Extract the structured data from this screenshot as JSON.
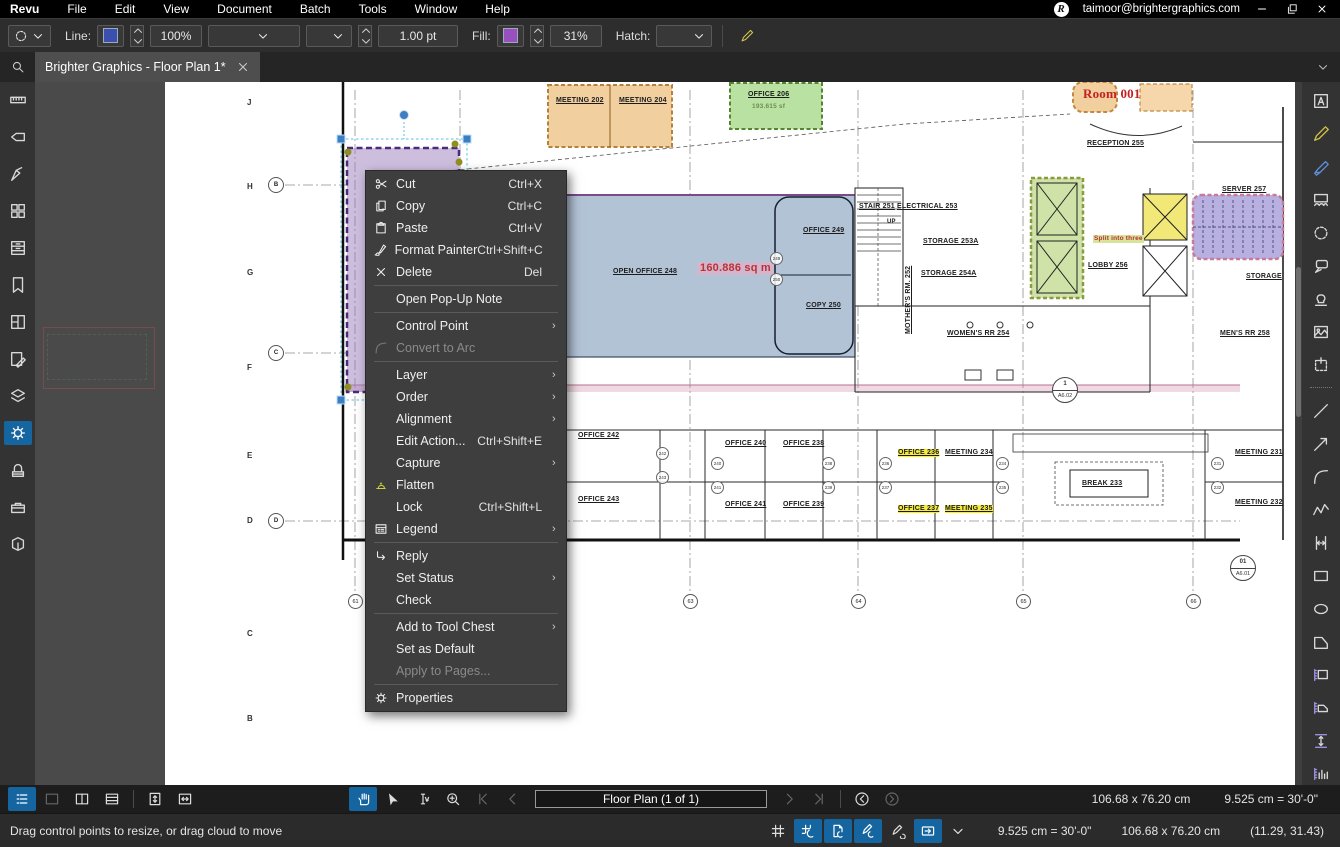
{
  "titlebar": {
    "menus": [
      "Revu",
      "File",
      "Edit",
      "View",
      "Document",
      "Batch",
      "Tools",
      "Window",
      "Help"
    ],
    "account": "taimoor@brightergraphics.com"
  },
  "toolbar": {
    "line_label": "Line:",
    "line_color": "#3b4fae",
    "line_opacity": "100%",
    "stroke_width": "1.00 pt",
    "fill_label": "Fill:",
    "fill_color": "#9a4fc0",
    "fill_opacity": "31%",
    "hatch_label": "Hatch:"
  },
  "tab": {
    "title": "Brighter Graphics - Floor Plan 1*"
  },
  "sidebar_left": {
    "items": [
      {
        "icon": "ruler",
        "name": "measurements-panel"
      },
      {
        "icon": "tag",
        "name": "flags-panel"
      },
      {
        "icon": "calibrate",
        "name": "calibration-panel"
      },
      {
        "icon": "thumbnails",
        "name": "thumbnails-panel"
      },
      {
        "icon": "drawer",
        "name": "file-access-panel"
      },
      {
        "icon": "bookmark",
        "name": "bookmarks-panel"
      },
      {
        "icon": "spaces",
        "name": "spaces-panel"
      },
      {
        "icon": "markups",
        "name": "markups-list-panel"
      },
      {
        "icon": "layers",
        "name": "layers-panel"
      },
      {
        "icon": "gear",
        "name": "tool-chest-panel",
        "active": true
      },
      {
        "icon": "scanner",
        "name": "studio-panel"
      },
      {
        "icon": "toolbox",
        "name": "toolbox-panel"
      },
      {
        "icon": "model",
        "name": "3d-model-panel"
      }
    ]
  },
  "sidebar_right": {
    "items": [
      {
        "icon": "text",
        "name": "text-tool"
      },
      {
        "icon": "pen",
        "name": "pen-tool",
        "color": "#cdbf45"
      },
      {
        "icon": "highlighter",
        "name": "highlighter-tool",
        "color": "#5d8fd6"
      },
      {
        "icon": "cloudrect",
        "name": "cloud-rect-tool"
      },
      {
        "icon": "cloud",
        "name": "cloud-tool"
      },
      {
        "icon": "callout",
        "name": "callout-tool"
      },
      {
        "icon": "stamp",
        "name": "stamp-tool"
      },
      {
        "icon": "image",
        "name": "image-tool"
      },
      {
        "icon": "snapshot",
        "name": "snapshot-tool"
      },
      {
        "divider": true
      },
      {
        "icon": "line",
        "name": "line-tool"
      },
      {
        "icon": "arrow",
        "name": "arrow-tool"
      },
      {
        "icon": "arc",
        "name": "arc-tool"
      },
      {
        "icon": "polyline",
        "name": "polyline-tool"
      },
      {
        "icon": "dimension",
        "name": "dimension-tool"
      },
      {
        "icon": "rect",
        "name": "rectangle-tool"
      },
      {
        "icon": "ellipse",
        "name": "ellipse-tool"
      },
      {
        "icon": "polygon",
        "name": "polygon-tool"
      },
      {
        "icon": "mrect",
        "name": "measure-rectangle-tool"
      },
      {
        "icon": "marea",
        "name": "measure-area-tool"
      },
      {
        "icon": "mlength",
        "name": "measure-length-tool"
      },
      {
        "icon": "mcount",
        "name": "measure-count-tool"
      }
    ]
  },
  "context_menu": {
    "items": [
      {
        "label": "Cut",
        "shortcut": "Ctrl+X",
        "icon": "scissors"
      },
      {
        "label": "Copy",
        "shortcut": "Ctrl+C",
        "icon": "copy"
      },
      {
        "label": "Paste",
        "shortcut": "Ctrl+V",
        "icon": "paste"
      },
      {
        "label": "Format Painter",
        "shortcut": "Ctrl+Shift+C",
        "icon": "brush"
      },
      {
        "label": "Delete",
        "shortcut": "Del",
        "icon": "xmark",
        "sep": true
      },
      {
        "label": "Open Pop-Up Note",
        "sep": true
      },
      {
        "label": "Control Point",
        "submenu": true
      },
      {
        "label": "Convert to Arc",
        "icon": "arc",
        "disabled": true,
        "sep": true
      },
      {
        "label": "Layer",
        "submenu": true
      },
      {
        "label": "Order",
        "submenu": true
      },
      {
        "label": "Alignment",
        "submenu": true
      },
      {
        "label": "Edit Action...",
        "shortcut": "Ctrl+Shift+E"
      },
      {
        "label": "Capture",
        "submenu": true
      },
      {
        "label": "Flatten",
        "icon": "flatten",
        "color": "#cfd13e"
      },
      {
        "label": "Lock",
        "shortcut": "Ctrl+Shift+L"
      },
      {
        "label": "Legend",
        "icon": "legend",
        "submenu": true,
        "sep": true
      },
      {
        "label": "Reply",
        "icon": "reply"
      },
      {
        "label": "Set Status",
        "submenu": true
      },
      {
        "label": "Check",
        "sep": true
      },
      {
        "label": "Add to Tool Chest",
        "submenu": true
      },
      {
        "label": "Set as Default"
      },
      {
        "label": "Apply to Pages...",
        "disabled": true,
        "sep": true
      },
      {
        "label": "Properties",
        "icon": "gear"
      }
    ]
  },
  "plan": {
    "rooms": [
      "MEETING  202",
      "MEETING  204",
      "OFFICE  206",
      "193.615 sf",
      "Room 001",
      "RECEPTION  255",
      "STAIR  251",
      "ELECTRICAL  253",
      "STORAGE  253A",
      "STORAGE  254A",
      "MOTHER'S RM.  252",
      "WOMEN'S RR  254",
      "MEN'S RR  258",
      "OPEN OFFICE  248",
      "160.886 sq m",
      "OFFICE  249",
      "COPY  250",
      "SERVER  257",
      "LOBBY  256",
      "Split into three",
      "STORAGE",
      "OFFICE  242",
      "OFFICE  243",
      "OFFICE  240",
      "OFFICE  241",
      "OFFICE  238",
      "OFFICE  239",
      "OFFICE  236",
      "OFFICE  237",
      "MEETING  234",
      "MEETING  235",
      "BREAK  233",
      "MEETING  231",
      "MEETING  232",
      "UP"
    ],
    "grid_rows": [
      "J",
      "H",
      "G",
      "F",
      "E",
      "D",
      "C",
      "B"
    ],
    "grid_bubbles": [
      "B",
      "C",
      "D"
    ],
    "grid_cols": [
      "61",
      "63",
      "64",
      "65",
      "66"
    ],
    "door_tags": [
      "249",
      "250",
      "242",
      "243",
      "240",
      "241",
      "238",
      "239",
      "236",
      "237",
      "234",
      "235",
      "231",
      "232"
    ],
    "callouts": [
      {
        "num": "1",
        "sheet": "A6.02"
      },
      {
        "num": "01",
        "sheet": "A6.01"
      }
    ]
  },
  "bottom_nav": {
    "left_tools": [
      {
        "icon": "markuplist",
        "name": "markups-list-toggle",
        "active": true
      },
      {
        "icon": "pane1",
        "name": "single-pane",
        "disabled": true
      },
      {
        "icon": "pane2",
        "name": "split-vertical"
      },
      {
        "icon": "pane3",
        "name": "split-horizontal"
      },
      {
        "divider": true
      },
      {
        "icon": "fitpage",
        "name": "fit-page"
      },
      {
        "icon": "fitwidth",
        "name": "fit-width"
      }
    ],
    "center_tools": [
      {
        "icon": "hand",
        "name": "pan-tool",
        "active": true
      },
      {
        "icon": "cursor",
        "name": "select-tool"
      },
      {
        "icon": "textselect",
        "name": "select-text-tool"
      },
      {
        "icon": "zoomplus",
        "name": "zoom-tool"
      },
      {
        "icon": "first",
        "name": "first-page-button",
        "disabled": true
      },
      {
        "icon": "prev",
        "name": "previous-page-button",
        "disabled": true
      },
      {
        "type": "pagebox",
        "name": "page-navigator",
        "bind": "bottom_nav.page_label"
      },
      {
        "icon": "next",
        "name": "next-page-button",
        "disabled": true
      },
      {
        "icon": "last",
        "name": "last-page-button",
        "disabled": true
      },
      {
        "divider": true
      },
      {
        "icon": "prevview",
        "name": "previous-view-button"
      },
      {
        "icon": "nextview",
        "name": "next-view-button",
        "disabled": true
      }
    ],
    "page_label": "Floor Plan (1 of 1)",
    "size": "106.68 x 76.20 cm",
    "scale": "9.525 cm = 30'-0\""
  },
  "status_bar": {
    "hint": "Drag control points to resize, or drag cloud to move",
    "icons": [
      {
        "icon": "grid",
        "name": "grid-toggle"
      },
      {
        "icon": "snapgrid",
        "name": "snap-to-grid",
        "active": true
      },
      {
        "icon": "snapdoc",
        "name": "snap-to-content",
        "active": true
      },
      {
        "icon": "snapmarkup",
        "name": "snap-to-markup",
        "active": true
      },
      {
        "icon": "pensync",
        "name": "pen-input-toggle"
      },
      {
        "icon": "sync",
        "name": "synchronize-views",
        "active": true
      },
      {
        "icon": "chevdown",
        "name": "sync-options"
      }
    ],
    "scale": "9.525 cm = 30'-0\"",
    "size": "106.68 x 76.20 cm",
    "coords": "(11.29, 31.43)"
  }
}
